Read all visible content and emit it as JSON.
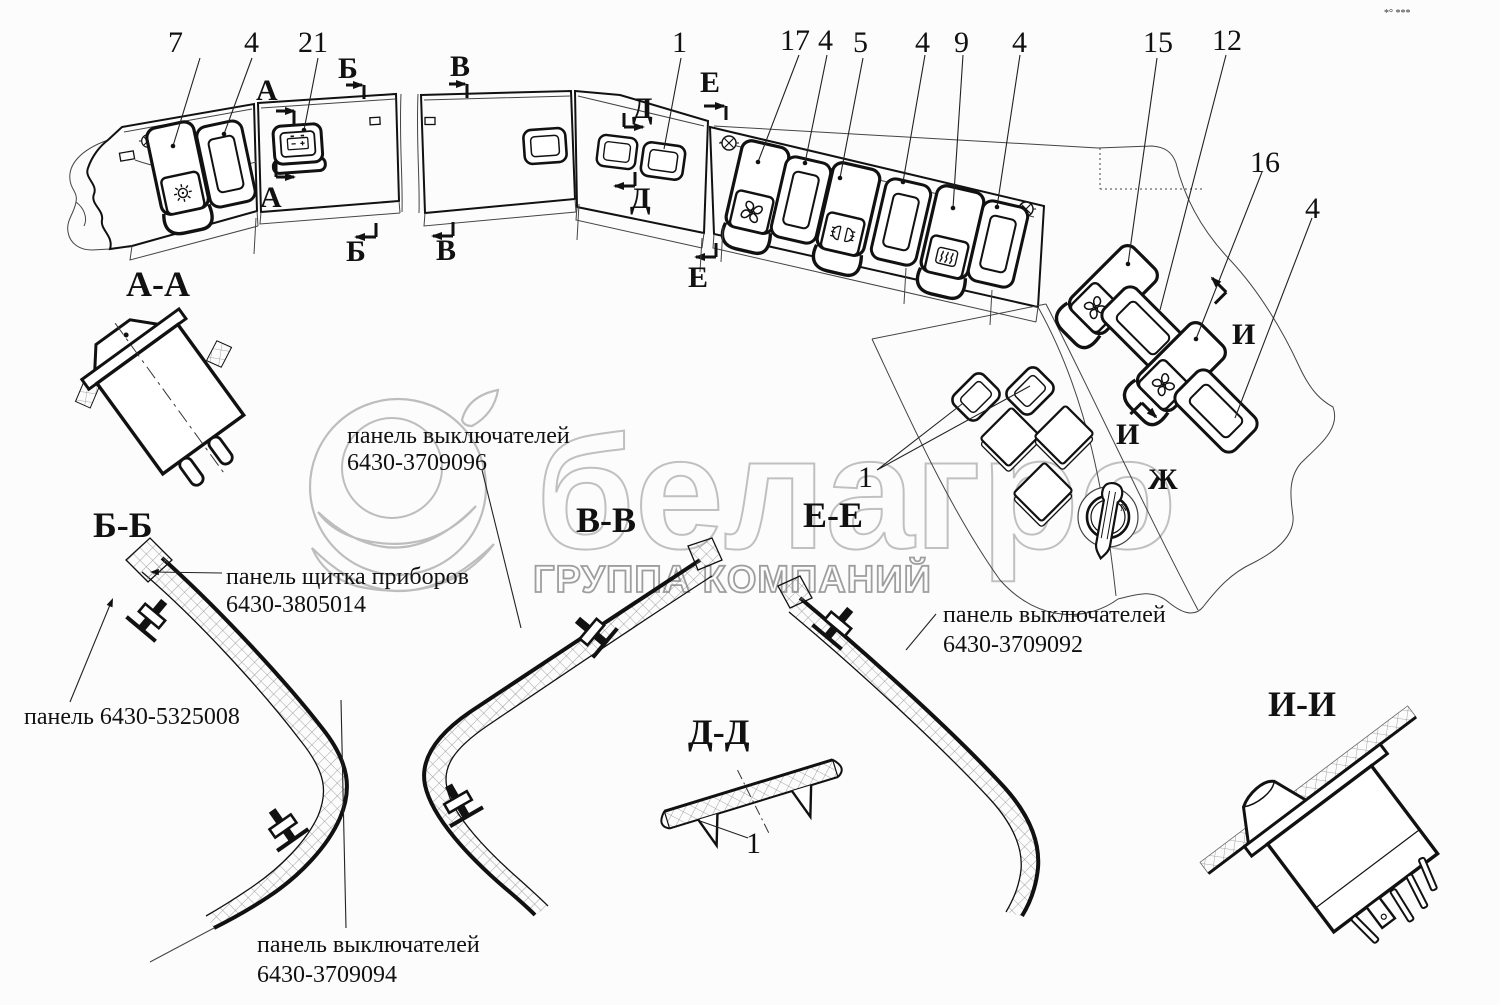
{
  "corner_marks": "*° ***",
  "watermark": {
    "brand": "белагро",
    "subtitle": "ГРУППА КОМПАНИЙ"
  },
  "ignition": {
    "mark": "N"
  },
  "callouts": {
    "n7": "7",
    "n4a": "4",
    "n21": "21",
    "n1a": "1",
    "n17": "17",
    "n4b": "4",
    "n5": "5",
    "n4c": "4",
    "n9": "9",
    "n4d": "4",
    "n15": "15",
    "n12": "12",
    "n16": "16",
    "n4e": "4",
    "n1b": "1",
    "n1c": "1"
  },
  "cut_marks": {
    "a1": "А",
    "a2": "А",
    "b1": "Б",
    "b2": "Б",
    "v1": "В",
    "v2": "В",
    "d1": "Д",
    "d2": "Д",
    "e1": "Е",
    "e2": "Е",
    "i1": "И",
    "i2": "И",
    "zh": "Ж"
  },
  "section_titles": {
    "aa": "А-А",
    "bb": "Б-Б",
    "vv": "В-В",
    "dd": "Д-Д",
    "ee": "Е-Е",
    "ii": "И-И"
  },
  "part_labels": {
    "switch_panel_096": {
      "line1": "панель выключателей",
      "line2": "6430-3709096"
    },
    "instrument_panel": {
      "line1": "панель щитка приборов",
      "line2": "6430-3805014"
    },
    "panel_5325008": {
      "line1": "панель 6430-5325008"
    },
    "switch_panel_092": {
      "line1": "панель выключателей",
      "line2": "6430-3709092"
    },
    "switch_panel_094": {
      "line1": "панель выключателей",
      "line2": "6430-3709094"
    }
  }
}
